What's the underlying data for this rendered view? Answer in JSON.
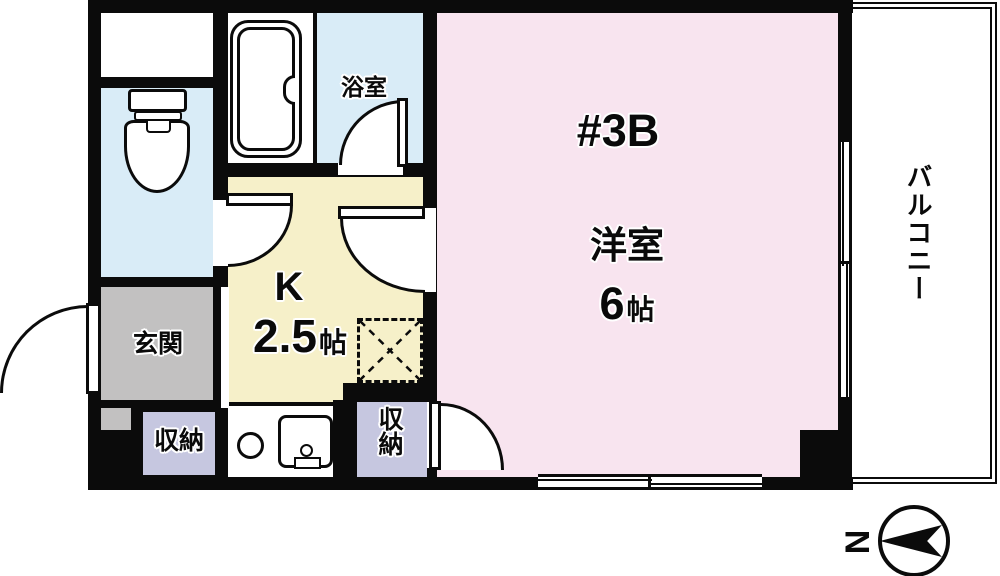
{
  "unit": {
    "label": "#3B"
  },
  "rooms": {
    "main": {
      "name": "洋室",
      "size_value": "6",
      "size_unit": "帖"
    },
    "kitchen": {
      "label": "K",
      "size_value": "2.5",
      "size_unit": "帖"
    },
    "bathroom": {
      "name": "浴室"
    },
    "entrance": {
      "name": "玄関"
    },
    "storage_left": {
      "name": "収納"
    },
    "storage_right": {
      "name": "収納"
    },
    "balcony": {
      "name": "バルコニー"
    }
  },
  "compass": {
    "north_label": "N"
  },
  "colors": {
    "wall": "#0b0b0b",
    "pink": "#f8e4ef",
    "yellow": "#f6f0c9",
    "blue": "#d9ecf7",
    "gray": "#c2c1c1",
    "lavender": "#c6c7e0"
  }
}
